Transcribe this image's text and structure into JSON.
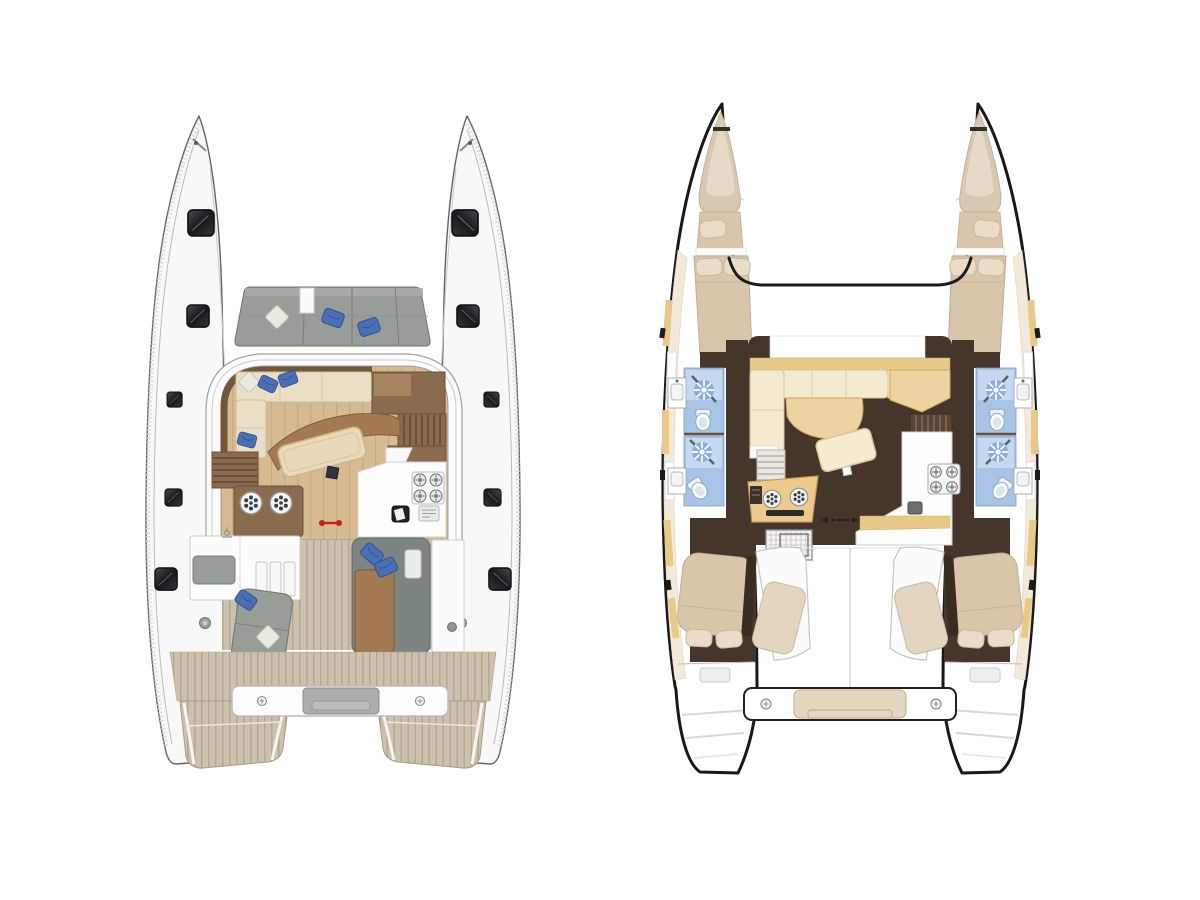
{
  "canvas": {
    "width": 1200,
    "height": 900,
    "background": "#ffffff"
  },
  "figure": {
    "kind": "catamaran-floor-plan-diagram",
    "views": [
      {
        "id": "deck-plan",
        "side": "left",
        "features": [
          "twin hulls with dark deck hatches",
          "foredeck lounge with gray cushions and blue pillows",
          "salon with cream L-sofa, curved dinette bench and tilted table",
          "galley with 4-burner stove, sink and control panel",
          "port counter with two burner rings",
          "port and starboard companionway stairs",
          "red centerline marker",
          "cockpit with gray sofas, brown sunpad and teak floor",
          "teak aft deck, transom beam with center step, stern swim wedges"
        ]
      },
      {
        "id": "interior-plan",
        "side": "right",
        "features": [
          "thick black hull outlines with cream side decks",
          "forepeak single berth and forward double berth per hull",
          "two blue bathrooms per hull with shower sunburst, toilet and wash basin",
          "salon with cream U-sofa, tan chaise, tilted table",
          "starboard galley with 4-burner stove and sink",
          "helm console with twin dials",
          "companionway stairs to each hull",
          "cockpit loungers, hatch grid box",
          "aft double cabins with pillows",
          "transom beam with tan step and stern platforms"
        ]
      }
    ]
  },
  "palette": {
    "deckHull": "#f8f8f9",
    "deckLine": "#606468",
    "grayCushion": "#979e98",
    "bluePillow": "#4a6fb5",
    "darkWood": "#8a6b4e",
    "midWood": "#a8845f",
    "sofaCream": "#eadfc4",
    "sofaCream2": "#f3ead0",
    "plankBase": "#d6ba92",
    "plankLine": "#c6aa81",
    "teakBase": "#ccc1ad",
    "teakLine": "#b5a890",
    "brownPad": "#a37a52",
    "red": "#c02315",
    "floorDark": "#46352a",
    "bedTan": "#d9c5aa",
    "pillowCream": "#eadcc6",
    "bathBlue": "#a7c3e5",
    "bathBlueLight": "#cde0f4",
    "showerBlue": "#89aede",
    "sideDeck": "#f2e9d8",
    "gunwale": "#e8c988",
    "chaiseTan": "#ecd3a0",
    "console": "#ecca8e",
    "hullLine": "#17181a"
  }
}
